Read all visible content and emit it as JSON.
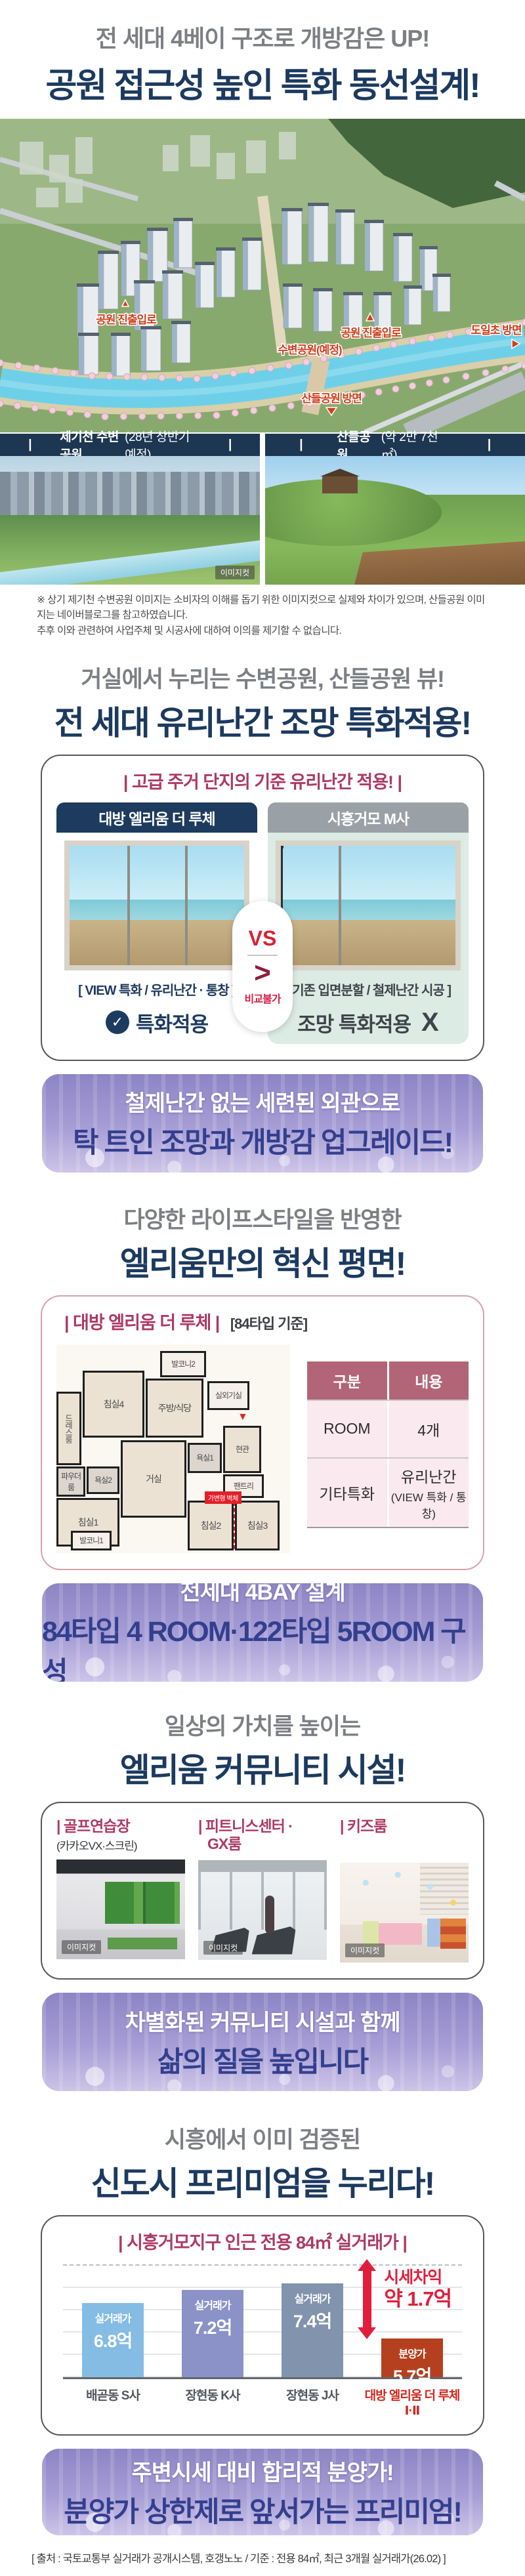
{
  "header": {
    "line1": "전 세대 4베이 구조로 개방감은 UP!",
    "line2": "공원 접근성 높인 특화 동선설계!"
  },
  "aerial": {
    "labels": {
      "gate1": "공원 진출입로",
      "gate2": "공원 진출입로",
      "river_park": "수변공원(예정)",
      "doil_school": "도일초 방면",
      "sandeul_dir": "산들공원 방면"
    }
  },
  "parks": {
    "left": {
      "bold": "제기천 수변공원",
      "rest": "(28년 상반기 예정)"
    },
    "right": {
      "bold": "산들공원",
      "rest": "(약 2만 7천㎡)"
    },
    "imagecut": "이미지컷"
  },
  "disclaimer": {
    "line1": "※ 상기 제기천 수변공원 이미지는 소비자의 이해를 돕기 위한 이미지컷으로 실제와 차이가 있으며, 산들공원 이미지는 네이버블로그를 참고하였습니다.",
    "line2": "추후 이와 관련하여 사업주체 및 시공사에 대하여 이의를 제기할 수 없습니다."
  },
  "view_section": {
    "line1": "거실에서 누리는 수변공원, 산들공원 뷰!",
    "line2": "전 세대 유리난간 조망 특화적용!"
  },
  "compare": {
    "title": "| 고급 주거 단지의 기준 유리난간 적용! |",
    "tab_left": "대방 엘리움 더 루체",
    "tab_right": "시흥거모 M사",
    "vs": "VS",
    "gt": ">",
    "no_compare": "비교불가",
    "caption_left": "[ VIEW 특화 / 유리난간 · 통창 ]",
    "caption_right": "[ 기존 입면분할 / 철제난간 시공 ]",
    "badge_left": "특화적용",
    "badge_right": "조망 특화적용",
    "badge_right_x": "X"
  },
  "banner1": {
    "line1": "철제난간 없는 세련된 외관으로",
    "line2": "탁 트인 조망과 개방감 업그레이드!"
  },
  "plan_section": {
    "line1": "다양한 라이프스타일을 반영한",
    "line2": "엘리움만의 혁신 평면!"
  },
  "plan_card": {
    "title": "| 대방 엘리움 더 루체 |",
    "subtitle": "[84타입 기준]"
  },
  "floorplan": {
    "rooms": {
      "bed1": "침실1",
      "bed2": "침실2",
      "bed3": "침실3",
      "bed4": "침실4",
      "living": "거실",
      "kitchen": "주방/식당",
      "bath1": "욕실1",
      "bath2": "욕실2",
      "entrance": "현관",
      "pantry": "팬트리",
      "balcony1": "발코니1",
      "balcony2": "발코니2",
      "dress": "드레스룸",
      "powder": "파우더룸",
      "outdoor_unit": "실외기실",
      "wall_tag": "가변형 벽체"
    }
  },
  "plan_table": {
    "header": [
      "구분",
      "내용"
    ],
    "row1": {
      "label": "ROOM",
      "value": "4개"
    },
    "row2": {
      "label": "기타특화",
      "value1": "유리난간",
      "value2": "(VIEW 특화 / 통창)"
    }
  },
  "banner2": {
    "line1": "전세대 4BAY 설계",
    "line2": "84타입 4 ROOM·122타입 5ROOM 구성"
  },
  "community": {
    "line1": "일상의 가치를 높이는",
    "line2": "엘리움 커뮤니티 시설!",
    "items": [
      {
        "title": "| 골프연습장",
        "title2": "",
        "sub": "(카카오VX·스크린)"
      },
      {
        "title": "| 피트니스센터 ·",
        "title2": "GX룸",
        "sub": ""
      },
      {
        "title": "| 키즈룸",
        "title2": "",
        "sub": ""
      }
    ],
    "imagecut": "이미지컷"
  },
  "banner3": {
    "line1": "차별화된 커뮤니티 시설과 함께",
    "line2": "삶의 질을 높입니다"
  },
  "premium_section": {
    "line1": "시흥에서 이미 검증된",
    "line2": "신도시 프리미엄을 누리다!"
  },
  "chart_data": {
    "type": "bar",
    "title": "| 시흥거모지구 인근 전용 84㎡ 실거래가 |",
    "categories": [
      "배곧동 S사",
      "장현동 K사",
      "장현동 J사",
      "대방 엘리움 더 루체 Ⅰ·Ⅱ"
    ],
    "values": [
      6.8,
      7.2,
      7.4,
      5.7
    ],
    "bar_labels": [
      [
        "실거래가",
        "6.8억"
      ],
      [
        "실거래가",
        "7.2억"
      ],
      [
        "실거래가",
        "7.4억"
      ],
      [
        "분양가",
        "5.7억"
      ]
    ],
    "bar_colors": [
      "#85bce4",
      "#8a92c8",
      "#8293ad",
      "#b5401f"
    ],
    "annotation": {
      "line1": "시세차익",
      "line2": "약 1.7억"
    },
    "ylim": [
      4.5,
      8
    ],
    "grid": true,
    "legend": "none",
    "unit": "억"
  },
  "banner4": {
    "line1": "주변시세 대비 합리적 분양가!",
    "line2": "분양가 상한제로 앞서가는 프리미엄!"
  },
  "footer": {
    "source": "[ 출처 : 국토교통부 실거래가 공개시스템, 호갱노노 / 기준 : 전용 84㎡, 최근 3개월 실거래가(26.02) ]"
  },
  "icons": {
    "check": "✓",
    "tri_down": "▼"
  }
}
